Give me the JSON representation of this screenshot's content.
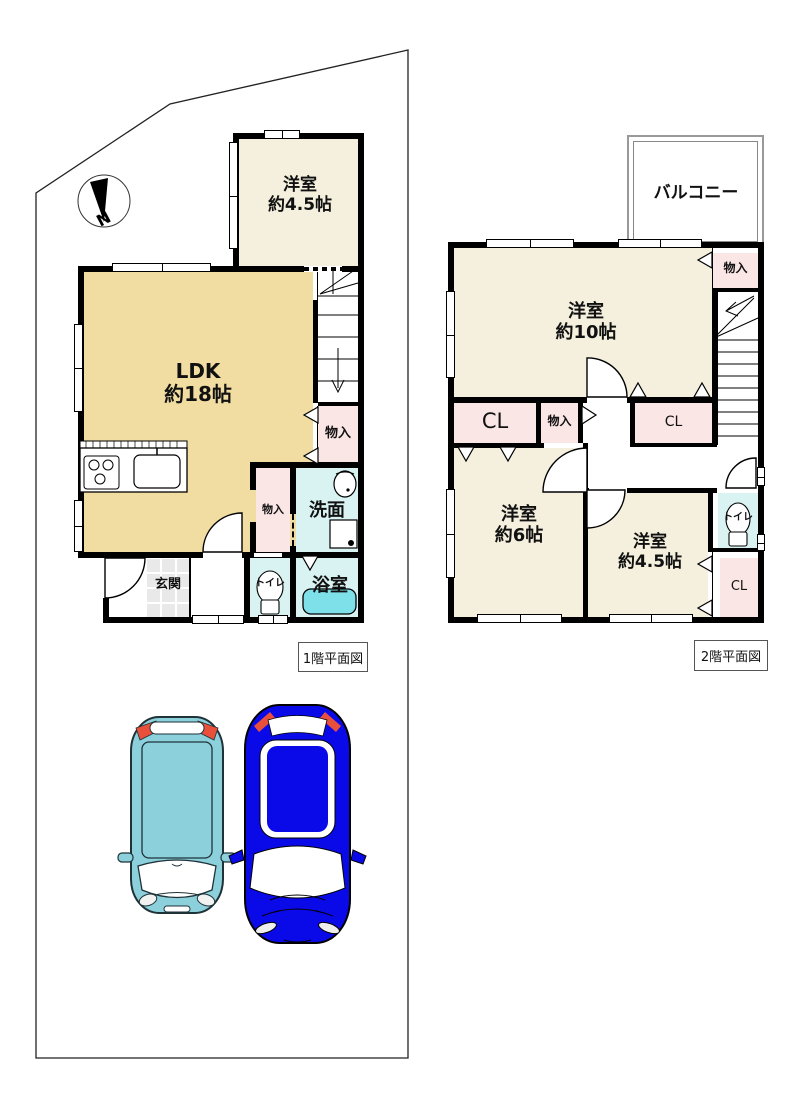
{
  "compass": {
    "label": "N"
  },
  "floor1": {
    "caption": "1階平面図",
    "rooms": {
      "yoshitsu45": {
        "name": "洋室",
        "size": "約4.5帖"
      },
      "ldk": {
        "name": "LDK",
        "size": "約18帖"
      },
      "monoiri_stair": "物入",
      "monoiri_small": "物入",
      "senmen": "洗面",
      "yokushitsu": "浴室",
      "toilet": "トイレ",
      "genkan": "玄関"
    }
  },
  "floor2": {
    "caption": "2階平面図",
    "rooms": {
      "balcony": "バルコニー",
      "yoshitsu10": {
        "name": "洋室",
        "size": "約10帖"
      },
      "monoiri_top": "物入",
      "cl_left": "CL",
      "monoiri_mid": "物入",
      "cl_right": "CL",
      "yoshitsu6": {
        "name": "洋室",
        "size": "約6帖"
      },
      "yoshitsu45": {
        "name": "洋室",
        "size": "約4.5帖"
      },
      "toilet": "トイレ",
      "cl_bottom": "CL"
    }
  },
  "colors": {
    "wall": "#000000",
    "room_cream": "#F5F0DE",
    "room_tan": "#F1DDA2",
    "room_pink": "#FBE6E6",
    "room_wet": "#D9F3F2",
    "tub": "#7EE0E8",
    "genkan_tile": "#E9E9E9",
    "car_teal": "#8CD0DC",
    "car_blue": "#0A0AE8",
    "tail_light": "#E8503C"
  }
}
